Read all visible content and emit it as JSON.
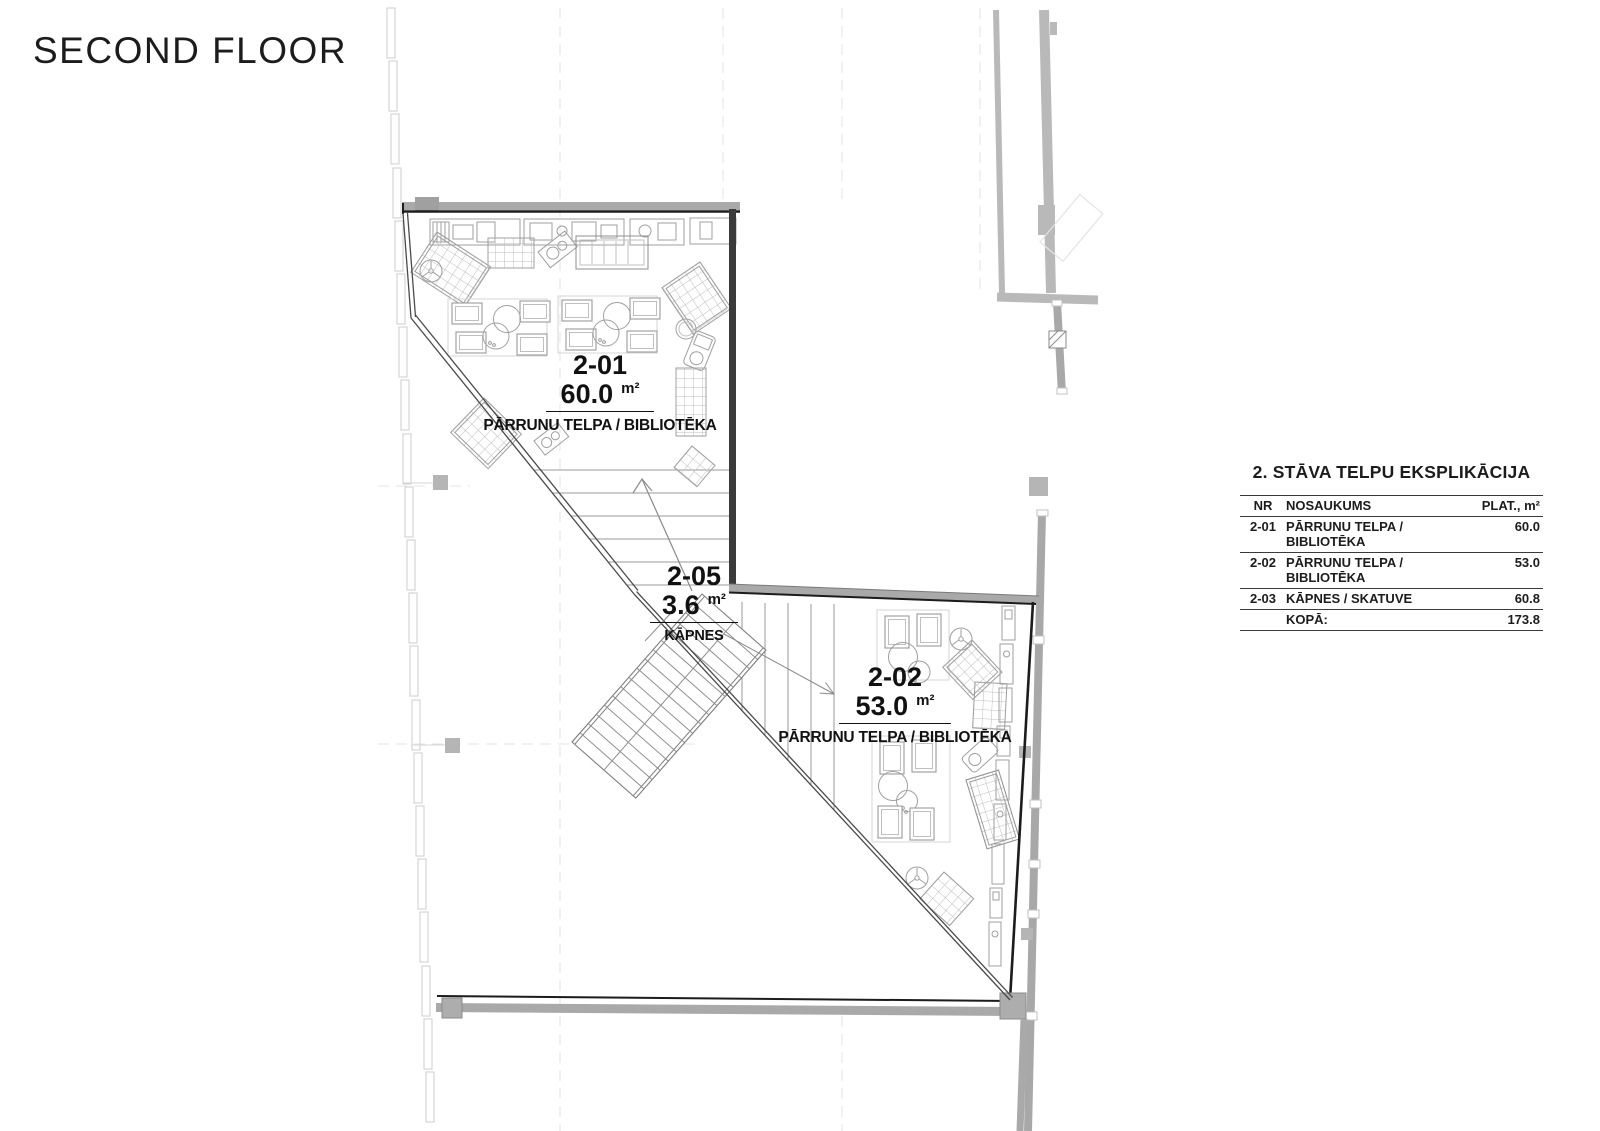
{
  "page": {
    "title": "SECOND FLOOR"
  },
  "rooms": [
    {
      "nr": "2-01",
      "area": "60.0",
      "unit": "m²",
      "name": "PĀRRUNU TELPA / BIBLIOTĒKA"
    },
    {
      "nr": "2-02",
      "area": "53.0",
      "unit": "m²",
      "name": "PĀRRUNU TELPA / BIBLIOTĒKA"
    },
    {
      "nr": "2-05",
      "area": "3.6",
      "unit": "m²",
      "name": "KĀPNES"
    }
  ],
  "legend": {
    "title": "2. STĀVA TELPU EKSPLIKĀCIJA",
    "columns": {
      "nr": "NR",
      "name": "NOSAUKUMS",
      "area": "PLAT., m²"
    },
    "rows": [
      {
        "nr": "2-01",
        "name": "PĀRRUNU TELPA / BIBLIOTĒKA",
        "area": "60.0"
      },
      {
        "nr": "2-02",
        "name": "PĀRRUNU TELPA / BIBLIOTĒKA",
        "area": "53.0"
      },
      {
        "nr": "2-03",
        "name": "KĀPNES / SKATUVE",
        "area": "60.8"
      },
      {
        "nr": "",
        "name": "KOPĀ:",
        "area": "173.8"
      }
    ]
  },
  "colors": {
    "wall_dark": "#1c1c1c",
    "wall_gray": "#a9a9a9",
    "curtain_gray": "#cdcdcd",
    "furniture_gray": "#9f9f9f"
  }
}
